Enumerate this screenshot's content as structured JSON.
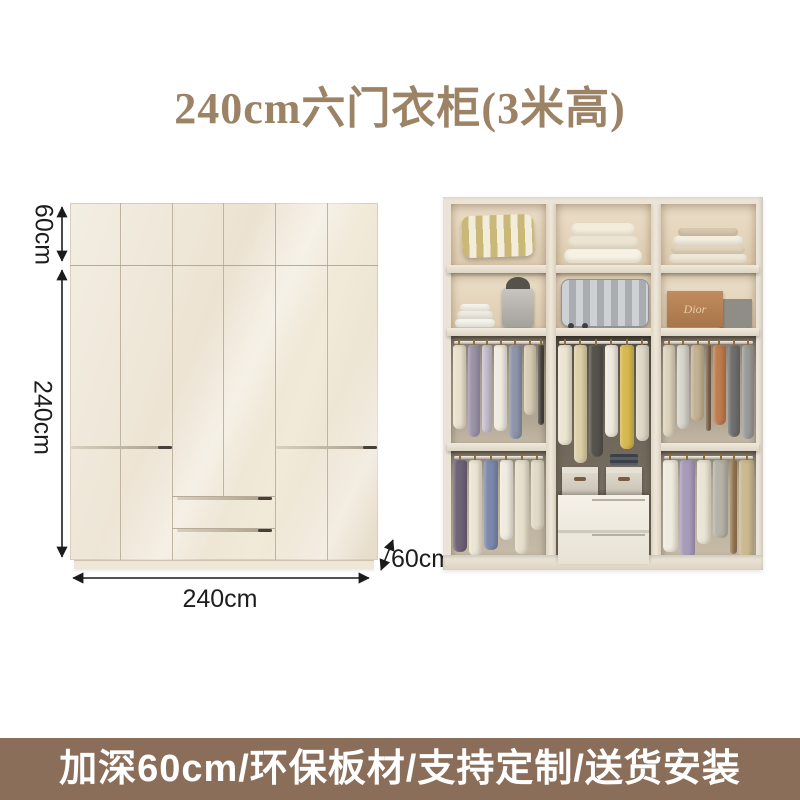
{
  "title": "240cm六门衣柜(3米高)",
  "banner": {
    "text": "加深60cm/环保板材/支持定制/送货安装",
    "bg": "#8a6e5a",
    "text_color": "#ffffff"
  },
  "dimensions": {
    "top_section_height": "60cm",
    "body_height": "240cm",
    "width": "240cm",
    "depth": "60cm"
  },
  "photo": {
    "dior_box_label": "Dior",
    "racks": {
      "r3c1": [
        {
          "c": "#eae1cd",
          "h": 84
        },
        {
          "c": "#9e94aa",
          "h": 92
        },
        {
          "c": "#c7bfcf",
          "h": 88,
          "w": 12
        },
        {
          "c": "#f0ece1",
          "h": 86
        },
        {
          "c": "#8e95ab",
          "h": 94
        },
        {
          "c": "#d8cdb4",
          "h": 70
        },
        {
          "c": "#4a443d",
          "h": 80,
          "w": 7
        }
      ],
      "r4c1": [
        {
          "c": "#6f6478",
          "h": 92
        },
        {
          "c": "#ece5d4",
          "h": 96
        },
        {
          "c": "#7c89ab",
          "h": 90
        },
        {
          "c": "#f0ebdf",
          "h": 80
        },
        {
          "c": "#e7dfcc",
          "h": 94
        },
        {
          "c": "#e2dac6",
          "h": 70
        }
      ],
      "mid": [
        {
          "c": "#ece5d2",
          "h": 100
        },
        {
          "c": "#ddd0a8",
          "h": 118
        },
        {
          "c": "#56524c",
          "h": 112
        },
        {
          "c": "#efeadf",
          "h": 92
        },
        {
          "c": "#d8b94f",
          "h": 104
        },
        {
          "c": "#e0d7c6",
          "h": 96
        }
      ],
      "r3c3": [
        {
          "c": "#ddd3bd",
          "h": 92
        },
        {
          "c": "#d8d5cc",
          "h": 84
        },
        {
          "c": "#c3b291",
          "h": 76
        },
        {
          "c": "#7d6347",
          "h": 86,
          "w": 7
        },
        {
          "c": "#c07c4e",
          "h": 80
        },
        {
          "c": "#6f6f6f",
          "h": 92
        },
        {
          "c": "#9b9b99",
          "h": 94
        }
      ],
      "r4c3": [
        {
          "c": "#f0ebdf",
          "h": 92
        },
        {
          "c": "#a89bb9",
          "h": 98
        },
        {
          "c": "#eae4d4",
          "h": 84
        },
        {
          "c": "#b5b2a8",
          "h": 78
        },
        {
          "c": "#9c7c54",
          "h": 94,
          "w": 7
        },
        {
          "c": "#cbb98f",
          "h": 98
        }
      ]
    }
  },
  "colors": {
    "title_text": "#9c8366",
    "banner_bg": "#8a6e5a",
    "cabinet_front": "#efe7d8",
    "photo_frame": "#eae3d6",
    "dimension_text": "#1d1d1d"
  }
}
